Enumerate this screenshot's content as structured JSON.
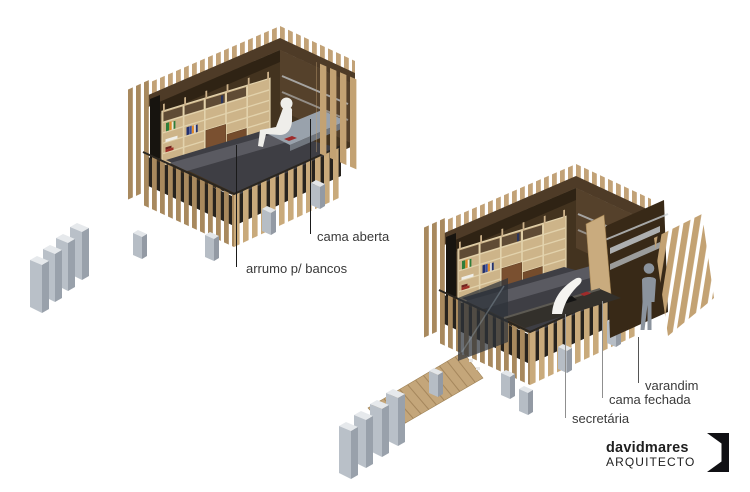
{
  "scene1": {
    "labels": {
      "arrumo": "arrumo p/ bancos",
      "cama_aberta": "cama aberta"
    }
  },
  "scene2": {
    "labels": {
      "secretaria": "secretária",
      "cama_fechada": "cama fechada",
      "varandim": "varandim"
    }
  },
  "logo": {
    "brand": "davidmares",
    "subtitle": "ARQUITECTO"
  },
  "colors": {
    "background": "#ffffff",
    "label_text": "#3a3a3a",
    "leader_dark": "#1a1a1a",
    "leader_gray": "#8f8f8f",
    "wood_light": "#c9ab7c",
    "wood_shadow": "#a8895e",
    "interior_brown": "#43331f",
    "plywood": "#cdb489",
    "concrete": "#b9c0c8",
    "logo_text": "#1f1f1f"
  }
}
